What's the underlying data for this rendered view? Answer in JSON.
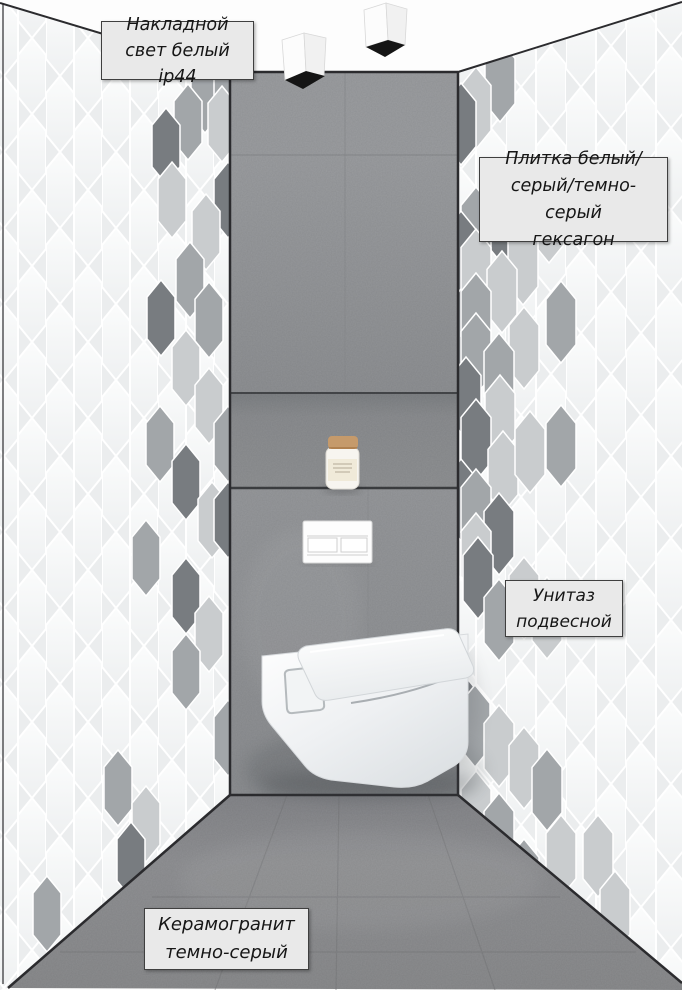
{
  "labels": {
    "ceiling_light": "Накладной\nсвет белый ip44",
    "wall_tile": "Плитка белый/\nсерый/темно-серый\nгексагон",
    "toilet": "Унитаз\nподвесной",
    "floor_tile": "Керамогранит\nтемно-серый"
  },
  "palette": {
    "white_tile": "#f8f9f9",
    "grout": "#ffffff",
    "hex_light": "#c9ccce",
    "hex_mid": "#a2a6a9",
    "hex_dark": "#787c80",
    "wall_concrete": "#97999c",
    "floor_grey": "#8d8e90",
    "outline": "#2b2b2e",
    "label_bg": "#e9e9e9",
    "cork_tan": "#c59a6b",
    "light_body_white": "#fbfbfb",
    "light_opening_black": "#151515",
    "toilet_white": "#ffffff"
  },
  "decor": {
    "left_wall": {
      "tile_w": 28,
      "tile_h": 76,
      "accents": [
        [
          222,
          58,
          "L"
        ],
        [
          205,
          95,
          "M"
        ],
        [
          228,
          86,
          "M"
        ],
        [
          222,
          124,
          "L"
        ],
        [
          188,
          122,
          "M"
        ],
        [
          166,
          146,
          "D"
        ],
        [
          228,
          200,
          "D"
        ],
        [
          172,
          200,
          "L"
        ],
        [
          206,
          232,
          "L"
        ],
        [
          190,
          280,
          "M"
        ],
        [
          161,
          318,
          "D"
        ],
        [
          209,
          320,
          "M"
        ],
        [
          186,
          368,
          "L"
        ],
        [
          209,
          406,
          "L"
        ],
        [
          160,
          444,
          "M"
        ],
        [
          228,
          444,
          "M"
        ],
        [
          186,
          482,
          "D"
        ],
        [
          212,
          520,
          "L"
        ],
        [
          228,
          520,
          "D"
        ],
        [
          146,
          558,
          "M"
        ],
        [
          186,
          596,
          "D"
        ],
        [
          209,
          634,
          "L"
        ],
        [
          186,
          672,
          "M"
        ],
        [
          228,
          738,
          "M"
        ],
        [
          118,
          788,
          "M"
        ],
        [
          146,
          824,
          "L"
        ],
        [
          131,
          860,
          "D"
        ],
        [
          191,
          882,
          "D"
        ],
        [
          161,
          896,
          "M"
        ],
        [
          228,
          890,
          "L"
        ],
        [
          206,
          920,
          "L"
        ],
        [
          186,
          954,
          "M"
        ],
        [
          47,
          914,
          "M"
        ]
      ]
    },
    "right_wall": {
      "tile_w": 30,
      "tile_h": 82,
      "accents": [
        [
          500,
          81,
          "M"
        ],
        [
          476,
          108,
          "L"
        ],
        [
          461,
          124,
          "D"
        ],
        [
          503,
          224,
          "D"
        ],
        [
          476,
          228,
          "M"
        ],
        [
          549,
          222,
          "L"
        ],
        [
          461,
          252,
          "D"
        ],
        [
          476,
          270,
          "L"
        ],
        [
          523,
          264,
          "L"
        ],
        [
          502,
          292,
          "L"
        ],
        [
          461,
          330,
          "D"
        ],
        [
          476,
          314,
          "M"
        ],
        [
          561,
          322,
          "M"
        ],
        [
          524,
          348,
          "L"
        ],
        [
          476,
          354,
          "M"
        ],
        [
          499,
          374,
          "M"
        ],
        [
          466,
          398,
          "D"
        ],
        [
          500,
          416,
          "L"
        ],
        [
          476,
          440,
          "D"
        ],
        [
          503,
          472,
          "L"
        ],
        [
          530,
          452,
          "L"
        ],
        [
          561,
          446,
          "M"
        ],
        [
          461,
          500,
          "D"
        ],
        [
          476,
          510,
          "M"
        ],
        [
          499,
          534,
          "D"
        ],
        [
          476,
          554,
          "L"
        ],
        [
          478,
          578,
          "D"
        ],
        [
          524,
          598,
          "L"
        ],
        [
          499,
          620,
          "M"
        ],
        [
          547,
          618,
          "L"
        ],
        [
          461,
          712,
          "D"
        ],
        [
          475,
          726,
          "M"
        ],
        [
          499,
          746,
          "L"
        ],
        [
          524,
          768,
          "L"
        ],
        [
          547,
          790,
          "M"
        ],
        [
          476,
          812,
          "L"
        ],
        [
          499,
          834,
          "M"
        ],
        [
          561,
          856,
          "L"
        ],
        [
          524,
          880,
          "M"
        ],
        [
          476,
          900,
          "M"
        ],
        [
          499,
          920,
          "D"
        ],
        [
          548,
          944,
          "L"
        ],
        [
          598,
          856,
          "L"
        ],
        [
          615,
          912,
          "L"
        ],
        [
          524,
          966,
          "M"
        ]
      ]
    }
  }
}
